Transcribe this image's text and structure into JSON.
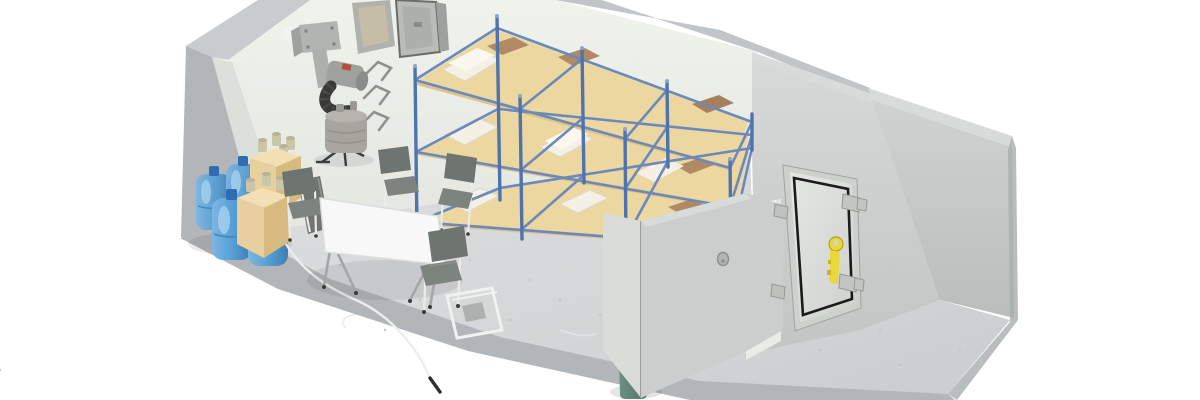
{
  "scene": {
    "description": "Isometric cutaway 3D render of a concrete fallout-shelter room",
    "objects": {
      "bunk_rack": {
        "tiers": 3,
        "bays": 3,
        "sleeping_pads": 9
      },
      "water_jugs": {
        "count": 5
      },
      "supply_crates": {
        "count": 2
      },
      "folding_chairs": {
        "count": 6
      },
      "folding_table": {
        "count": 1
      },
      "blast_door": {
        "count": 1
      },
      "toilet_bucket": {
        "count": 1
      },
      "air_filtration_unit": {
        "count": 1
      },
      "wall_hooks": {
        "count": 3
      }
    }
  },
  "palette": {
    "background": "#ffffff",
    "rim": "#c9ccce",
    "rim_light": "#d8dbd9",
    "slab_edge": "#b3b6b8",
    "wall_back": "#ebeee8",
    "wall_left": "#dce0da",
    "wall_right_face": "#cdd1cf",
    "wall_cut_face": "#c6cac8",
    "floor": "#d6d8d9",
    "stall_wall": "#cbcecd",
    "stall_wall_light": "#d9dcd9",
    "doorway_white": "#f5f6f3",
    "door_frame": "#cdd0cc",
    "door_panel": "#dcdfdc",
    "door_seal": "#1b1b1b",
    "door_handle_yellow": "#ecd73b",
    "hinge": "#c2c5c1",
    "bunk_frame": "#4f74ab",
    "bunk_rail": "#6b89bb",
    "mattress": "#ecd7a0",
    "mattress_side": "#dfc488",
    "blanket": "#f4f0e5",
    "pillow": "#b08a64",
    "jug_blue": "#5a9fd4",
    "jug_cap": "#2f6db3",
    "crate_top": "#f2e0b4",
    "crate_front": "#e8cf9e",
    "crate_side": "#d7ba7e",
    "can": "#ccc6a8",
    "metal": "#b2b4b0",
    "metal_dark": "#9a9c98",
    "hose_black": "#3a3a38",
    "accent_red": "#b84c3c",
    "chair_panel": "#6e7470",
    "chair_frame": "#eceeec",
    "table_top": "#f7f8f7",
    "table_leg": "#a2a6a5",
    "bucket_green": "#5d8375",
    "bucket_top": "#6f9486",
    "hook_metal": "#8e918e"
  }
}
